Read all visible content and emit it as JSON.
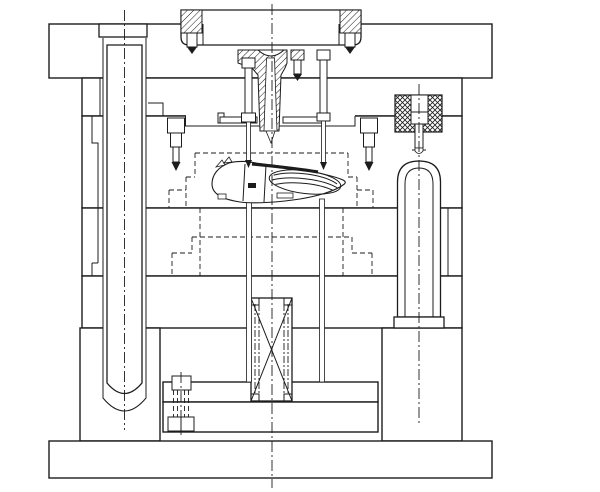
{
  "page": {
    "title": "Injection mold assembly - sectional engineering drawing",
    "background_color": "#ffffff",
    "line_color": "#1c1c1c"
  },
  "drawing": {
    "style": "black-and-white 2D CAD section view, no text or dimensions visible",
    "canvas": {
      "width": 600,
      "height": 492
    },
    "components": [
      {
        "id": "locating-ring",
        "glyph": "rounded flange block with two hatched socket bolts, top center"
      },
      {
        "id": "top-clamp-plate",
        "glyph": "widest upper plate"
      },
      {
        "id": "sprue-bushing",
        "glyph": "hatched tapered bushing on mold centerline"
      },
      {
        "id": "runner-plate-bar",
        "glyph": "thin bar under sprue bushing"
      },
      {
        "id": "cavity-plate-a",
        "glyph": "upper mold plate pair"
      },
      {
        "id": "core-plate-b",
        "glyph": "lower mold plate"
      },
      {
        "id": "support-plate",
        "glyph": "plate under core plate"
      },
      {
        "id": "spacer-rail-left",
        "glyph": "left riser block"
      },
      {
        "id": "spacer-rail-right",
        "glyph": "right riser block"
      },
      {
        "id": "ejector-retainer-plate",
        "glyph": "upper ejector plate"
      },
      {
        "id": "ejector-base-plate",
        "glyph": "lower ejector plate"
      },
      {
        "id": "bottom-clamp-plate",
        "glyph": "widest bottom plate"
      },
      {
        "id": "guide-pillar-left",
        "glyph": "long pillar with head, round bottom, dash-dot axis"
      },
      {
        "id": "guide-bushing-right",
        "glyph": "dome-top sleeve with bottom flange"
      },
      {
        "id": "latch-lock",
        "glyph": "cross-hatched block with pin, right side"
      },
      {
        "id": "spring",
        "glyph": "rectangle with X and dash-dot coils, center bottom"
      },
      {
        "id": "molded-part",
        "glyph": "mouse-shell shaped part in cavity"
      },
      {
        "id": "insert-pockets",
        "glyph": "stepped dashed hidden outlines"
      },
      {
        "id": "puller-pins",
        "glyph": "two thin headed pins from top reaching the part"
      },
      {
        "id": "ejector-pins",
        "glyph": "two thin pins from part down to ejector plates"
      },
      {
        "id": "side-stop-screws",
        "glyph": "two small downward screws in cavity plate"
      },
      {
        "id": "ejector-plate-screw",
        "glyph": "hidden-line screw in ejector plates, lower left"
      },
      {
        "id": "ring-bolts",
        "glyph": "hatched-head cap screws with pointed tips"
      }
    ]
  }
}
